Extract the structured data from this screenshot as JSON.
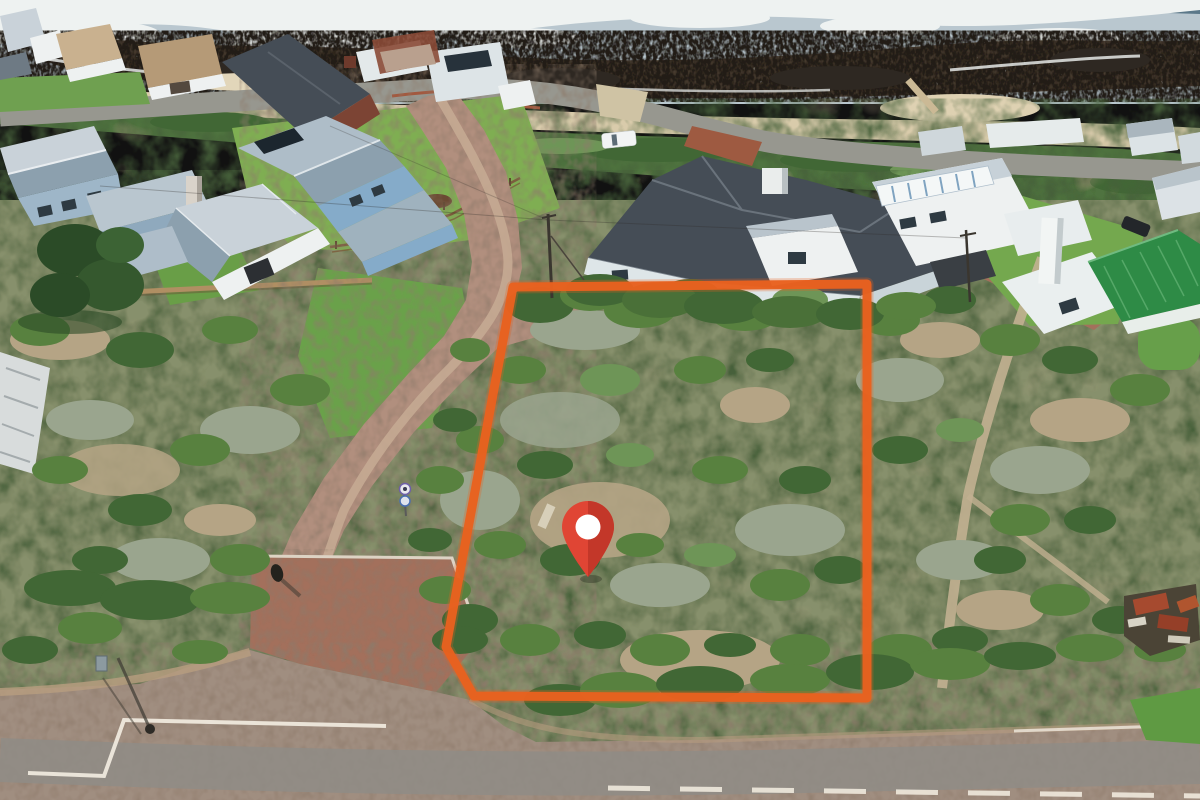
{
  "scene": {
    "type": "aerial-drone-photograph",
    "subject": "vacant coastal stand outlined in orange with a red location pin, beachfront houses and rocky surf shoreline behind",
    "regions": [
      "ocean-surf",
      "rocky-reef",
      "beach-sand",
      "dune-vegetation",
      "beachfront-houses",
      "tar-street",
      "dirt-road",
      "brick-apron",
      "gravel-road",
      "vacant-plot",
      "veld-scrub",
      "ruin"
    ]
  },
  "theme": {
    "ocean_water": "#b9c7cf",
    "ocean_deep": "#5b7889",
    "ocean_foam": "#eef2f1",
    "reef_rock": "#4a3e31",
    "beach_sand": "#d9cbab",
    "dune_green": "#4f7340",
    "veld_base": "#87906c",
    "lawn_green": "#7fae52",
    "street_grey": "#97978f",
    "dirt_road": "#b18f7e",
    "brick_paving": "#a3705c",
    "road_tar": "#a08e80",
    "road_marking": "#efe9dd",
    "bush_green": "#58813f",
    "bush_dark": "#416735",
    "bush_light": "#6e9557",
    "dry_scrub": "#9aa58e",
    "sand_patch": "#b5a485",
    "tree_dark": "#2b4b27",
    "wall_white": "#eef1f1",
    "wall_blue": "#85abc9",
    "brick_wall": "#7c4434",
    "roof_dark": "#454d56",
    "roof_green": "#2e8b46"
  },
  "overlay": {
    "plot_outline": {
      "path": "M513,287 L867,284 L867,698 L474,696 L446,647 Z",
      "color": "#E8611F",
      "stroke_width": "9"
    },
    "pin": {
      "transform": "translate(588,533)",
      "body_color": "#E04534",
      "shade_color": "#C03528",
      "dot_color": "#FFFFFF"
    }
  }
}
